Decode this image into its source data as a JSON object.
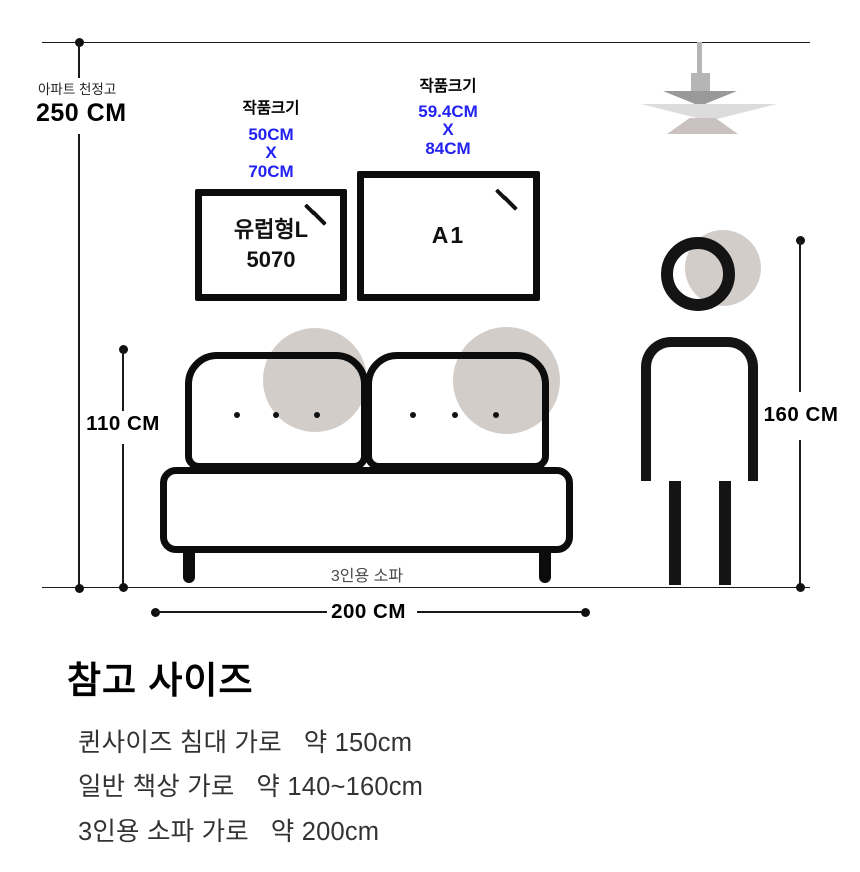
{
  "colors": {
    "accent_blue": "#2222f2",
    "line_black": "#1a1a1a",
    "outline_black": "#0c0c0c",
    "gray_fill": "#d3cdca",
    "lamp_dark": "#999999",
    "lamp_light": "#dcdcdc",
    "lamp_mid": "#c9c2c0"
  },
  "ceiling": {
    "caption": "아파트 천정고",
    "value": "250 CM"
  },
  "artworks": [
    {
      "size_title": "작품크기",
      "width": "50CM",
      "sep": "X",
      "height": "70CM",
      "label_line1": "유럽형L",
      "label_line2": "5070"
    },
    {
      "size_title": "작품크기",
      "width": "59.4CM",
      "sep": "X",
      "height": "84CM",
      "label": "A1"
    }
  ],
  "sofa": {
    "caption": "3인용 소파",
    "height_label": "110 CM",
    "width_label": "200 CM"
  },
  "person": {
    "height_label": "160 CM"
  },
  "reference": {
    "title": "참고 사이즈",
    "items": [
      "퀸사이즈 침대 가로   약 150cm",
      "일반 책상 가로   약 140~160cm",
      "3인용 소파 가로   약 200cm"
    ]
  }
}
